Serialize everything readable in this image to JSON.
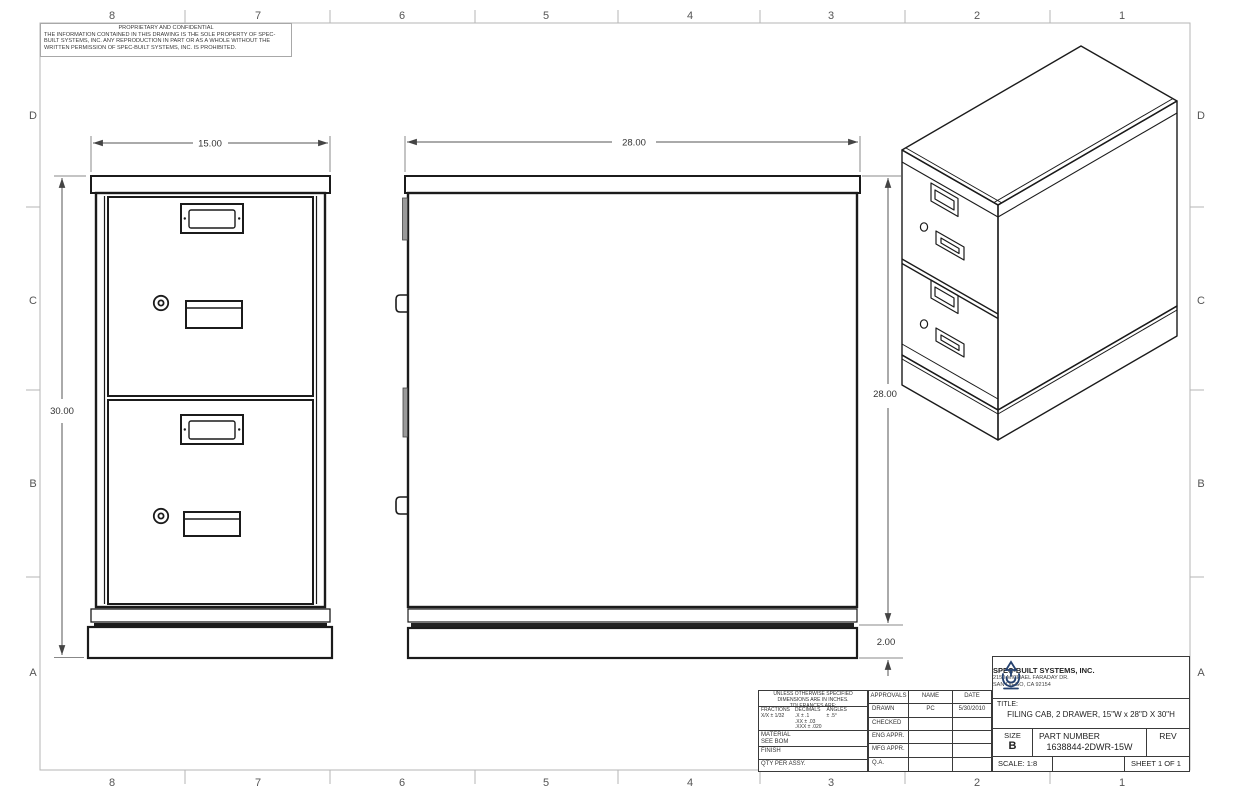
{
  "zones": {
    "top": [
      "8",
      "7",
      "6",
      "5",
      "4",
      "3",
      "2",
      "1"
    ],
    "bottom": [
      "8",
      "7",
      "6",
      "5",
      "4",
      "3",
      "2",
      "1"
    ],
    "left": [
      "D",
      "C",
      "B",
      "A"
    ],
    "right": [
      "D",
      "C",
      "B",
      "A"
    ]
  },
  "proprietary": {
    "heading": "PROPRIETARY AND CONFIDENTIAL",
    "body": "THE INFORMATION CONTAINED IN THIS DRAWING IS THE SOLE PROPERTY OF SPEC-BUILT SYSTEMS, INC.  ANY REPRODUCTION IN PART OR AS A WHOLE WITHOUT THE WRITTEN PERMISSION OF SPEC-BUILT SYSTEMS, INC. IS PROHIBITED."
  },
  "dimensions": {
    "front_width": "15.00",
    "overall_height": "30.00",
    "depth": "28.00",
    "body_height": "28.00",
    "base_height": "2.00"
  },
  "tolerance_block": {
    "general": "UNLESS OTHERWISE SPECIFIED DIMENSIONS ARE IN INCHES.  TOLERANCES ARE:",
    "fractions_label": "FRACTIONS",
    "fractions": "X/X ± 1/32",
    "decimals_label": "DECIMALS",
    "decimals_1": ".X  ± .1",
    "decimals_2": ".XX  ± .03",
    "decimals_3": ".XXX ± .020",
    "angles_label": "ANGLES",
    "angles": "± .5°",
    "material_label": "MATERIAL",
    "material_value": "SEE BOM",
    "finish_label": "FINISH",
    "qty_label": "QTY PER ASSY."
  },
  "approvals": {
    "headers": [
      "APPROVALS",
      "NAME",
      "DATE"
    ],
    "rows": [
      {
        "label": "DRAWN",
        "name": "PC",
        "date": "5/30/2010"
      },
      {
        "label": "CHECKED",
        "name": "",
        "date": ""
      },
      {
        "label": "ENG APPR.",
        "name": "",
        "date": ""
      },
      {
        "label": "MFG APPR.",
        "name": "",
        "date": ""
      },
      {
        "label": "Q.A.",
        "name": "",
        "date": ""
      }
    ]
  },
  "title_block": {
    "company": "SPEC-BUILT SYSTEMS, INC.",
    "address1": "2150 MICHAEL FARADAY DR.",
    "address2": "SAN DIEGO, CA 92154",
    "title_label": "TITLE:",
    "title": "FILING CAB, 2 DRAWER, 15\"W x 28\"D X 30\"H",
    "size_label": "SIZE",
    "size": "B",
    "part_number_label": "PART NUMBER",
    "part_number": "1638844-2DWR-15W",
    "rev_label": "REV",
    "scale": "SCALE: 1:8",
    "sheet": "SHEET 1 OF 1"
  },
  "colors": {
    "line": "#1b1b1b",
    "dimension": "#555555",
    "frame": "#b6b6b6",
    "logo_navy": "#24406e",
    "background": "#ffffff"
  }
}
